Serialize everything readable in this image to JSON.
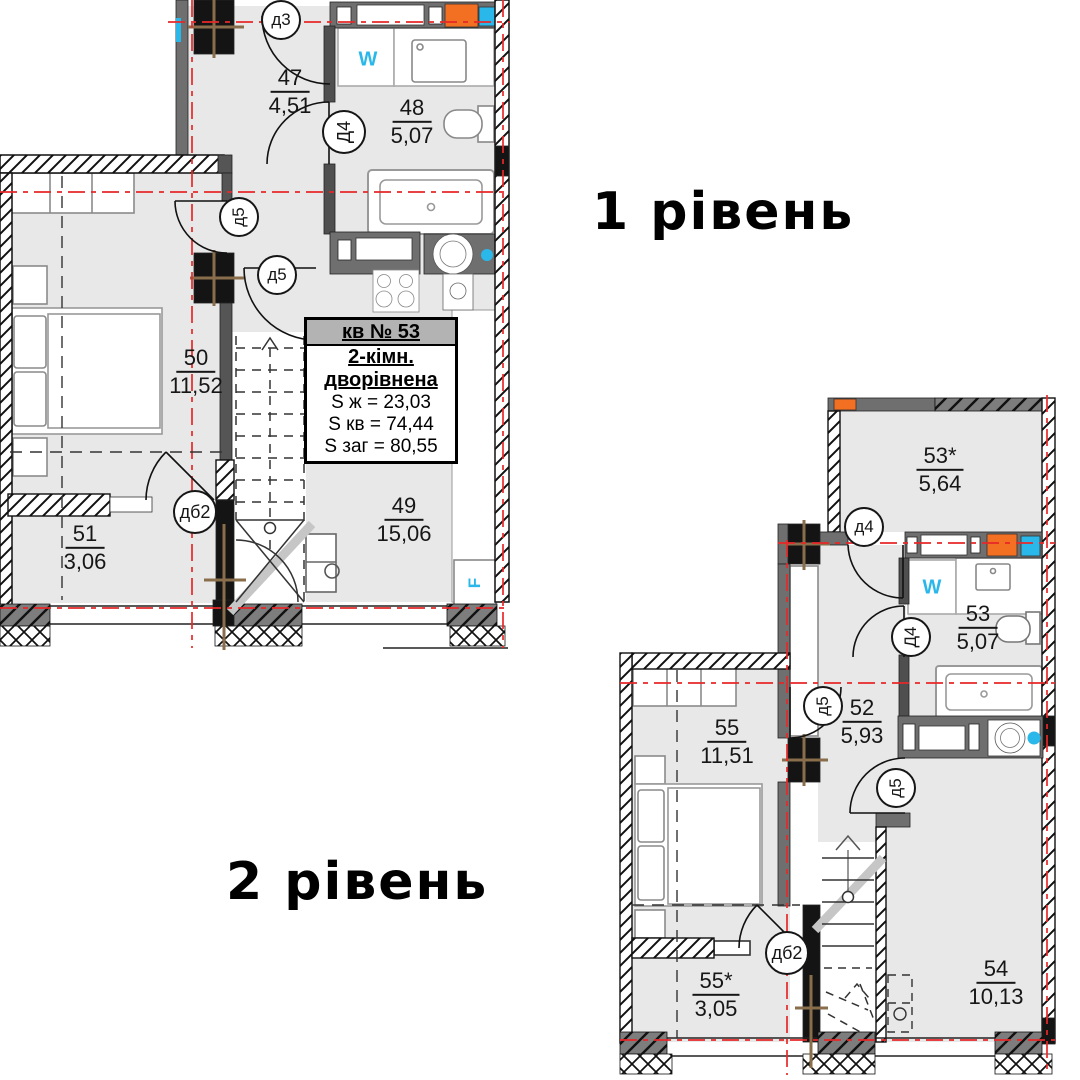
{
  "levels": {
    "level1": {
      "title": "1 рівень",
      "rooms": [
        {
          "number": "47",
          "area": "4,51"
        },
        {
          "number": "48",
          "area": "5,07"
        },
        {
          "number": "50",
          "area": "11,52"
        },
        {
          "number": "51",
          "area": "3,06"
        },
        {
          "number": "49",
          "area": "15,06"
        }
      ],
      "doors": [
        {
          "label": "д3"
        },
        {
          "label": "Д4"
        },
        {
          "label": "д5"
        },
        {
          "label": "д5"
        },
        {
          "label": "дб2"
        }
      ],
      "fixtures": {
        "washer": "W",
        "fridge": "F"
      }
    },
    "level2": {
      "title": "2 рівень",
      "rooms": [
        {
          "number": "53*",
          "area": "5,64"
        },
        {
          "number": "53",
          "area": "5,07"
        },
        {
          "number": "55",
          "area": "11,51"
        },
        {
          "number": "52",
          "area": "5,93"
        },
        {
          "number": "54",
          "area": "10,13"
        },
        {
          "number": "55*",
          "area": "3,05"
        }
      ],
      "doors": [
        {
          "label": "д4"
        },
        {
          "label": "Д4"
        },
        {
          "label": "д5"
        },
        {
          "label": "д5"
        },
        {
          "label": "дб2"
        }
      ],
      "fixtures": {
        "washer": "W"
      }
    }
  },
  "info_box": {
    "apartment": "кв № 53",
    "type_line1": "2-кімн.",
    "type_line2": "дворівнена",
    "area_living": "S ж = 23,03",
    "area_apartment": "S кв = 74,44",
    "area_total": "S заг = 80,55"
  },
  "colors": {
    "wall_gray": "#6f6f6f",
    "floor_gray": "#e8e8e8",
    "axis_red": "#e82828",
    "accent_orange": "#f36f21",
    "accent_cyan": "#2ab7e9",
    "column_black": "#141414",
    "axis_tan": "#8a6e4b"
  }
}
